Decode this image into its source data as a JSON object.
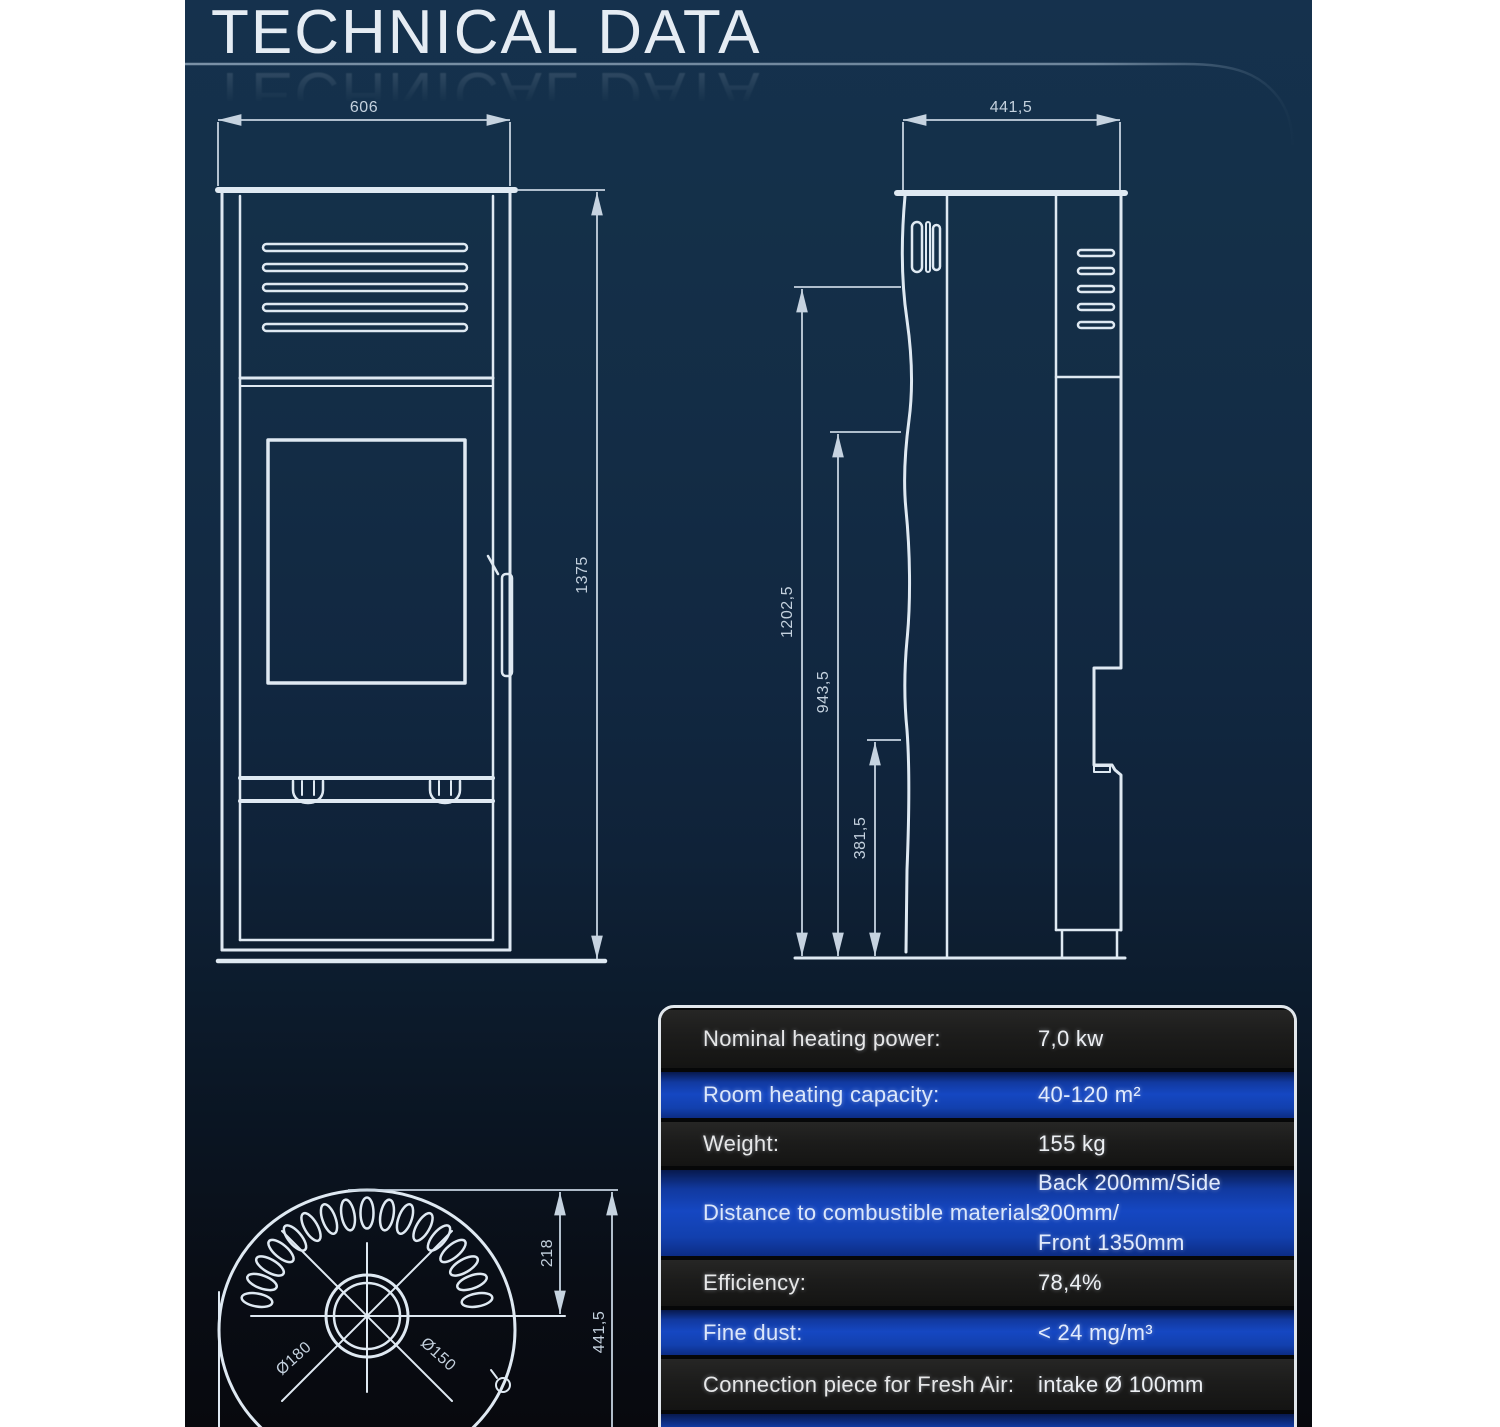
{
  "title": {
    "text": "TECHNICAL DATA"
  },
  "front_view": {
    "width_dim": "606",
    "height_dim": "1375"
  },
  "side_view": {
    "depth_dim": "441,5",
    "height_total_dim": "1202,5",
    "height_mid_dim": "943,5",
    "height_low_dim": "381,5"
  },
  "top_view": {
    "offset_dim": "218",
    "depth_dim": "441,5",
    "flue_outer_dia": "Ø180",
    "flue_inner_dia": "Ø150"
  },
  "spec_table": {
    "rows": [
      {
        "label": "Nominal heating power:",
        "value": "7,0 kw"
      },
      {
        "label": "Room heating capacity:",
        "value": "40-120 m²"
      },
      {
        "label": "Weight:",
        "value": "155 kg"
      },
      {
        "label": "Distance to combustible materials:",
        "value": "Back 200mm/Side 200mm/",
        "value2": "Front 1350mm"
      },
      {
        "label": "Efficiency:",
        "value": "78,4%"
      },
      {
        "label": "Fine dust:",
        "value": "< 24 mg/m³"
      },
      {
        "label": "Connection piece for Fresh Air:",
        "value": "intake Ø 100mm"
      }
    ]
  },
  "colors": {
    "panel_navy": "#15314d",
    "panel_bottom": "#08090e",
    "row_blue": "#1547c2",
    "row_dark": "#1c1c1b",
    "line": "#dfe9f2",
    "table_border": "#e2e7ec"
  }
}
